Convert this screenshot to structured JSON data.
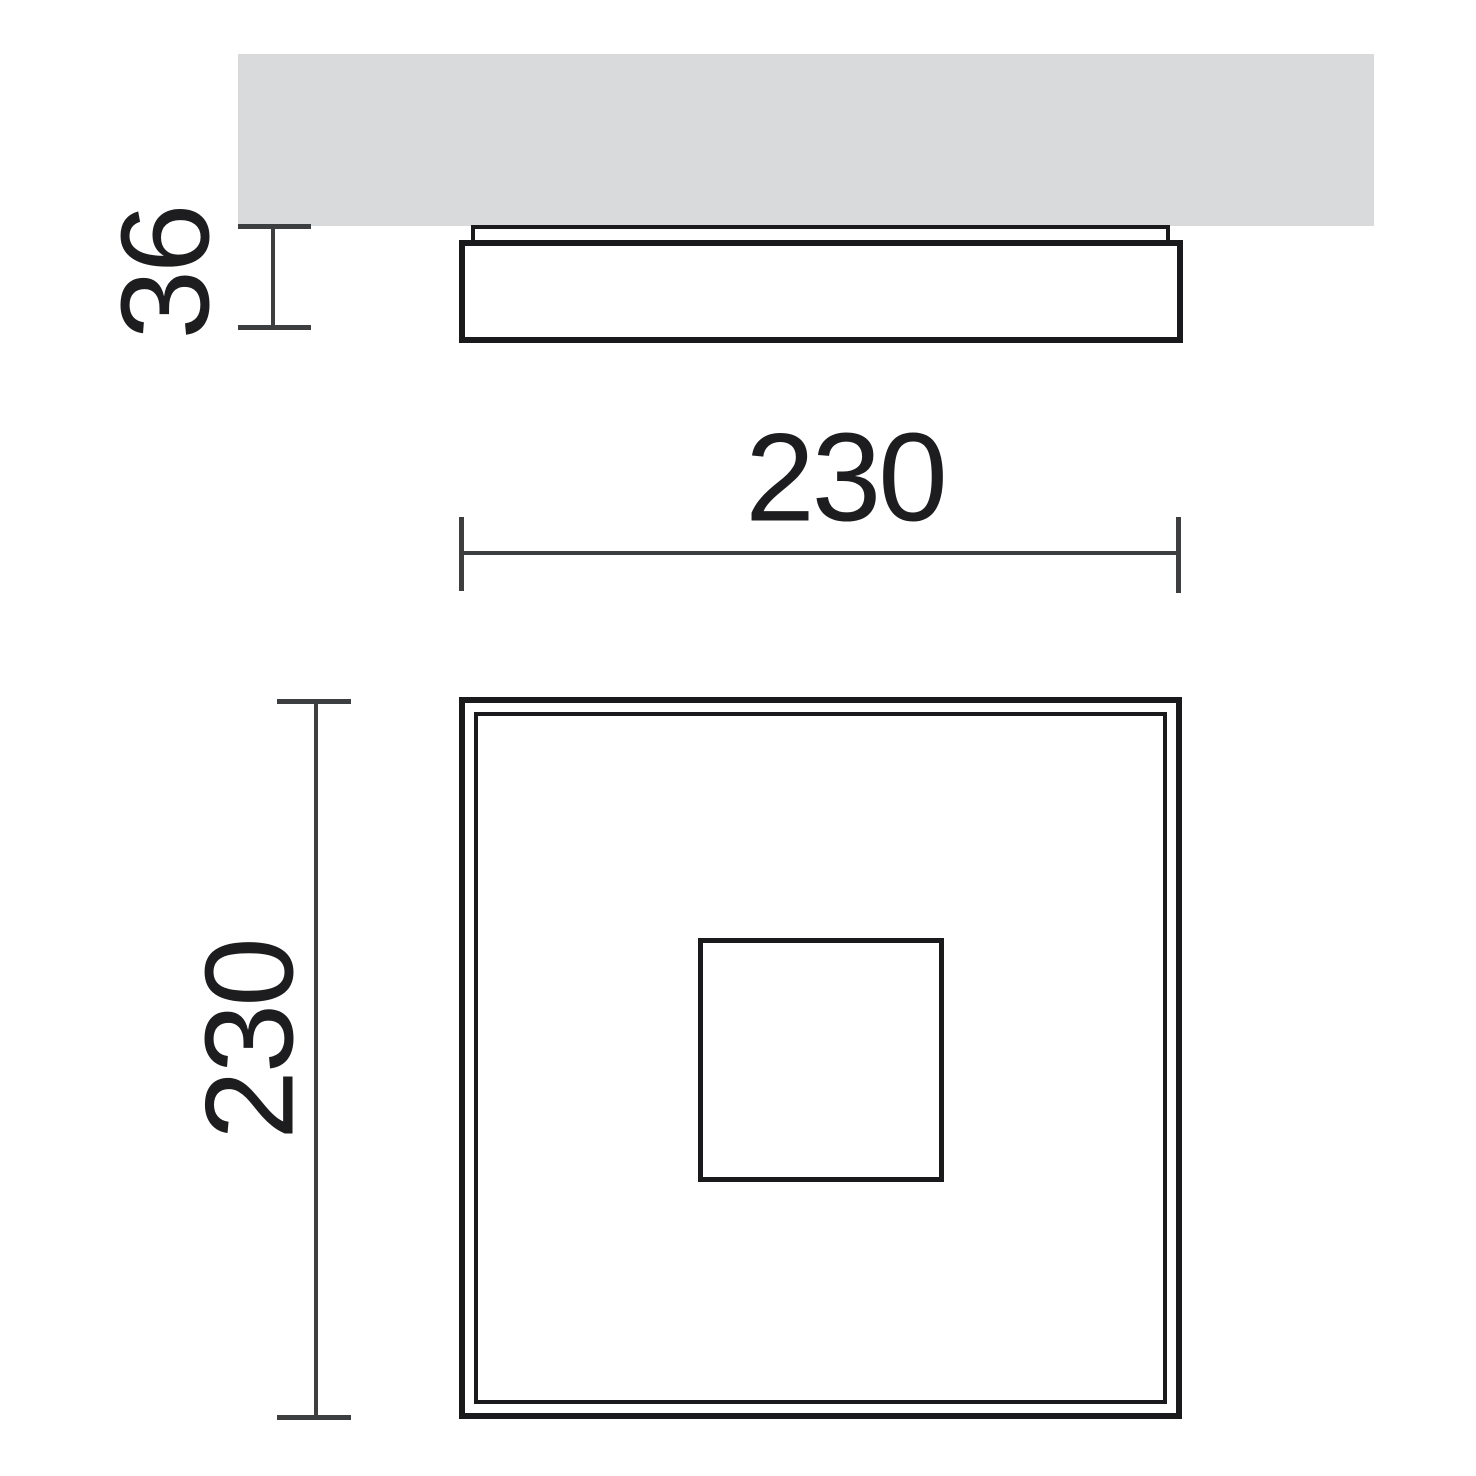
{
  "diagram": {
    "title": "square-ceiling-light-dimension-drawing",
    "labels": {
      "height_mm": "36",
      "width_mm": "230",
      "depth_mm": "230"
    },
    "colors": {
      "background": "#ffffff",
      "ceiling_fill": "#d9dadb",
      "dimension_line": "#3d3e40",
      "outline": "#1a1a1c",
      "text": "#1d1d1f"
    }
  }
}
